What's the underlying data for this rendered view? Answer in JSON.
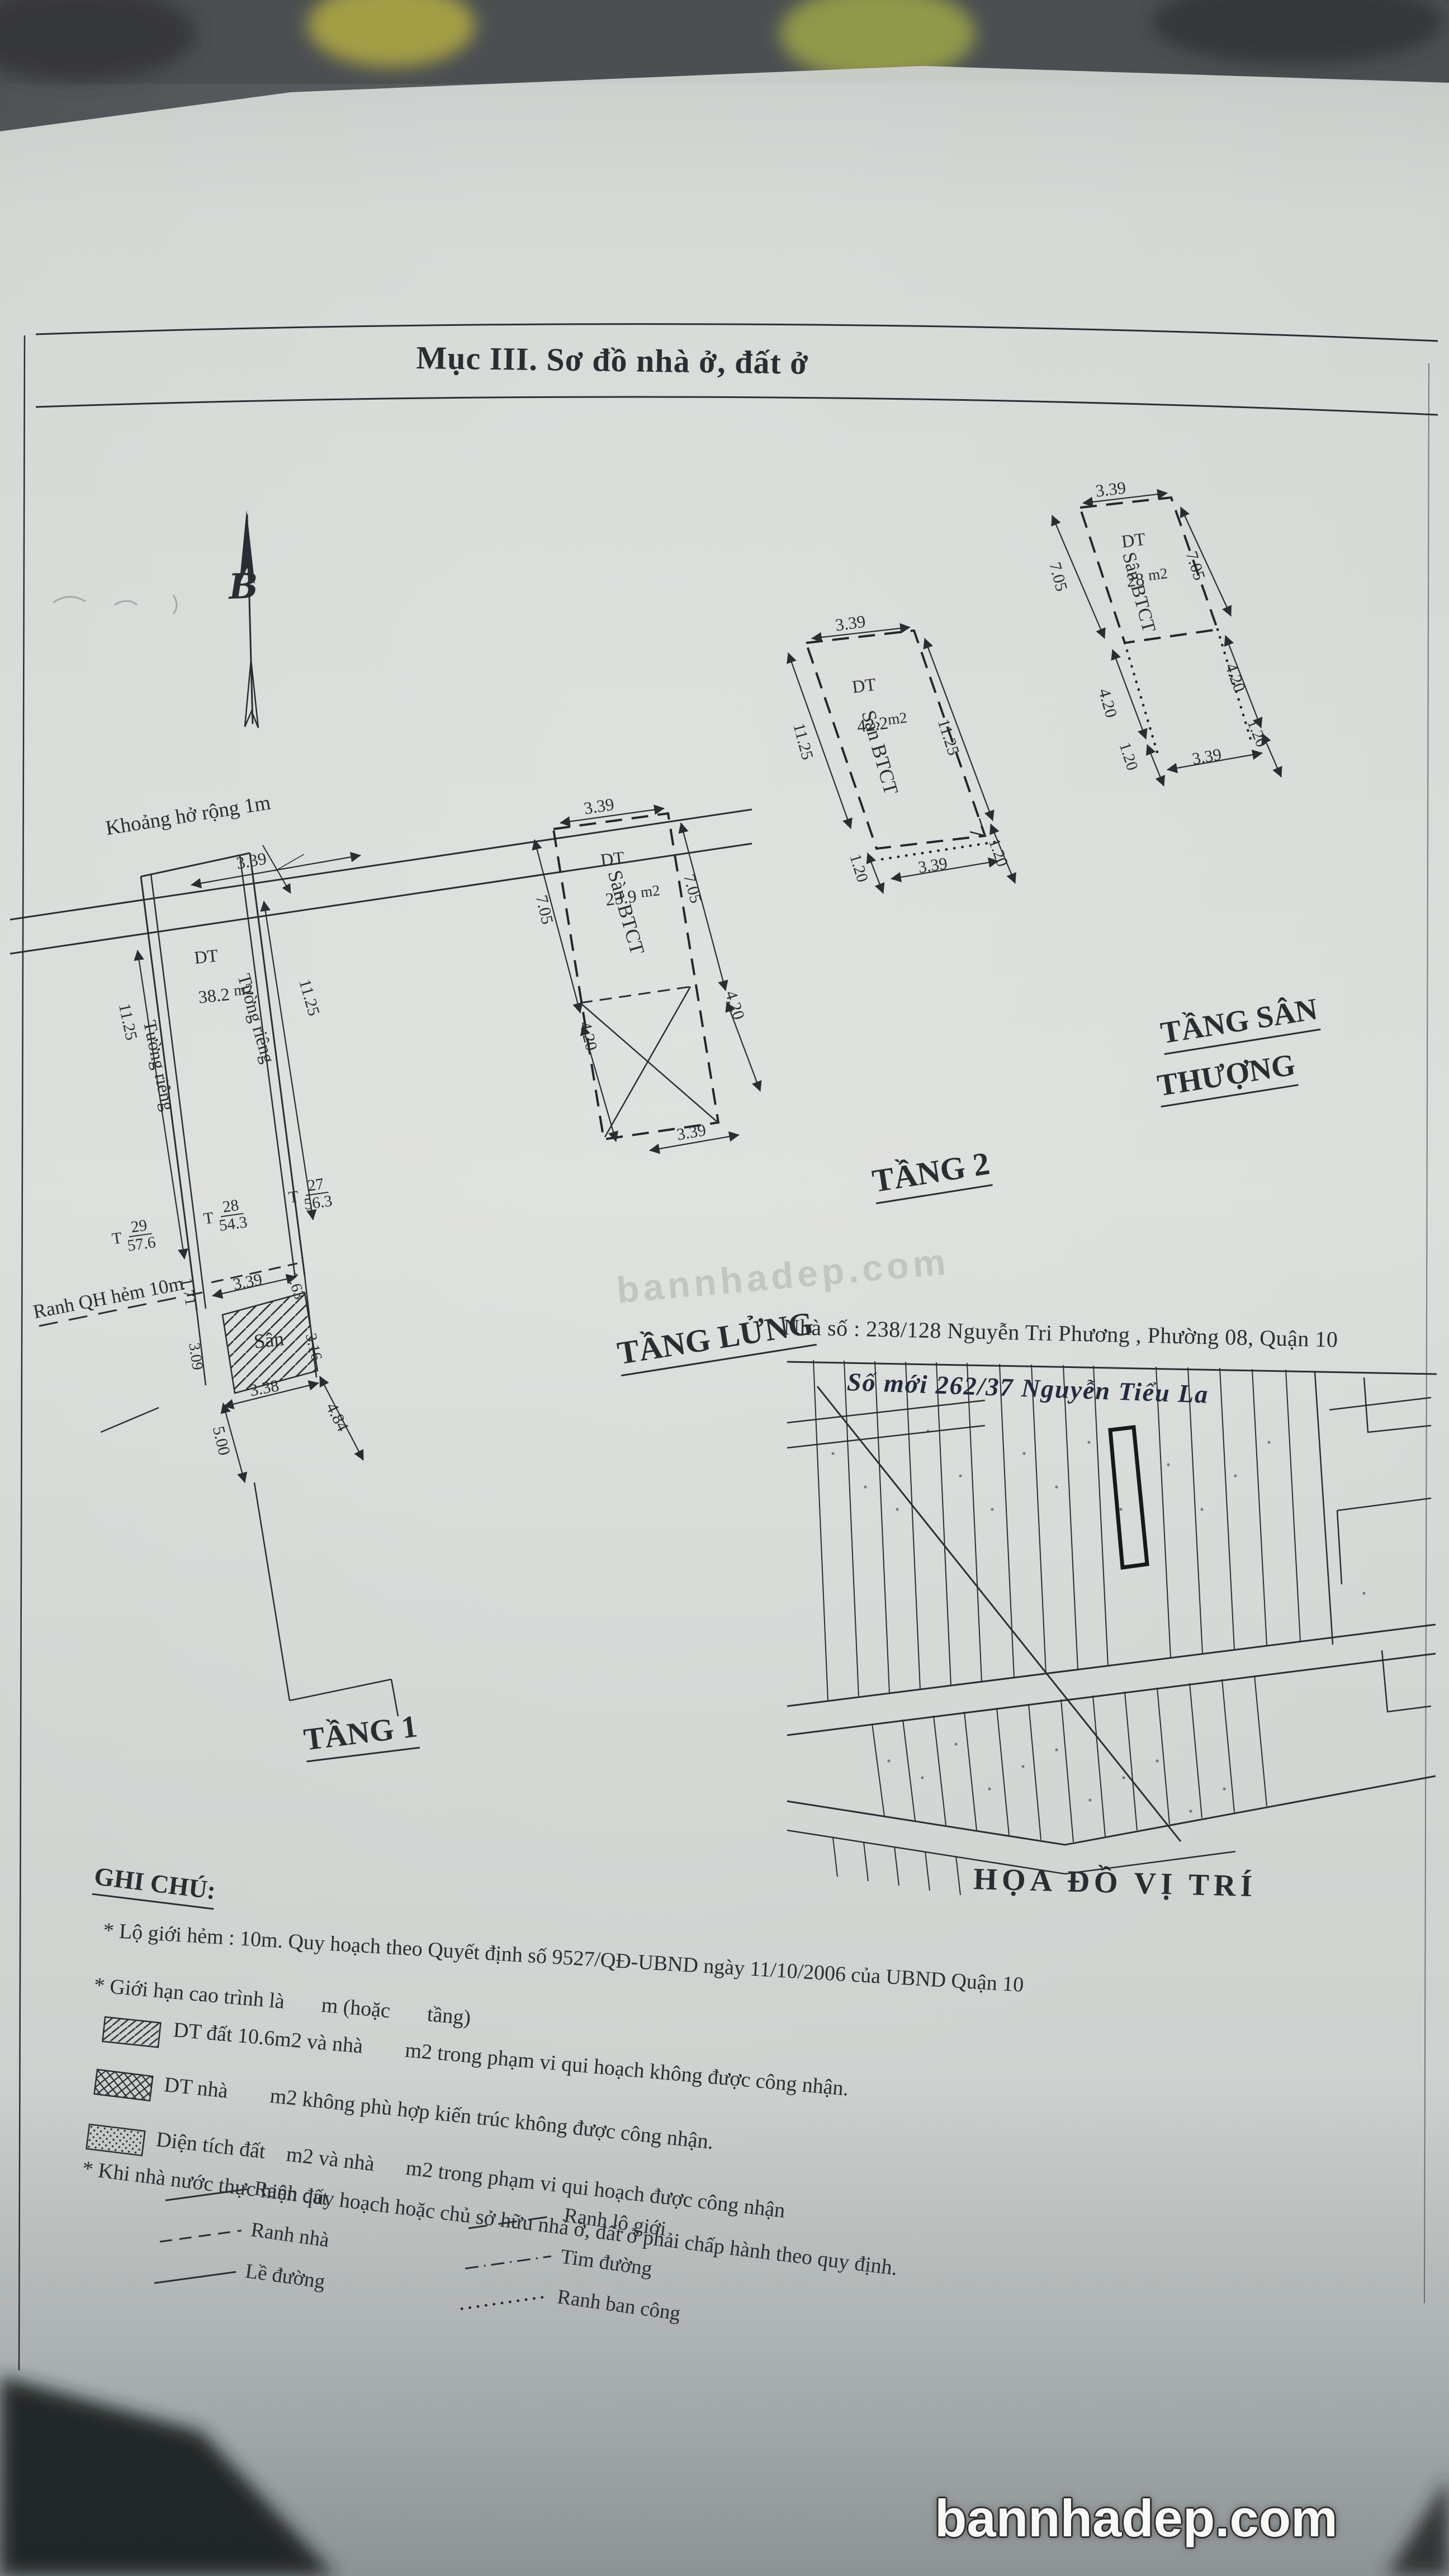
{
  "photo": {
    "ink_color": "#2b2d33",
    "paper_color": "#d6dad6"
  },
  "header": {
    "title": "Mục III. Sơ đồ nhà ở, đất ở"
  },
  "compass": {
    "letter": "B"
  },
  "plans": {
    "tang1": {
      "label": "TẦNG 1",
      "gap_note": "Khoảng hở rộng 1m",
      "alley_note": "Ranh QH hẻm 10m",
      "area_label": "DT",
      "area_value": "38.2",
      "area_unit": "m2",
      "wall_left": "Tường riêng",
      "wall_right": "Tường riêng",
      "yard_label": "Sân",
      "lot_prefix": "T",
      "lots": [
        {
          "no": "29",
          "area": "57.6"
        },
        {
          "no": "28",
          "area": "54.3"
        },
        {
          "no": "27",
          "area": "56.3"
        }
      ],
      "dims": {
        "front": "3.39",
        "left": "11.25",
        "right": "11.25",
        "inner_front": "3.39",
        "left_a": "1.71",
        "left_b": "3.09",
        "right_a": "1.63",
        "right_b": "3.16",
        "yard_width": "3.38",
        "bottom_left": "5.00",
        "bottom_right": "4.84"
      }
    },
    "tang_lung": {
      "label": "TẦNG LỬNG",
      "area_label": "DT",
      "area_value": "23.9",
      "area_unit": "m2",
      "floor_label": "Sàn BTCT",
      "dims": {
        "front": "3.39",
        "left_upper": "7.05",
        "right_upper": "7.05",
        "left_lower": "4.20",
        "right_lower": "4.20",
        "bottom": "3.39"
      }
    },
    "tang2": {
      "label": "TẦNG 2",
      "area_label": "DT",
      "area_value": "42.2",
      "area_unit": "m2",
      "floor_label": "Sân BTCT",
      "dims": {
        "front": "3.39",
        "left": "11.25",
        "right": "11.25",
        "bottom_left": "1.20",
        "bottom_right": "1.20",
        "bottom": "3.39"
      }
    },
    "tang_san_thuong": {
      "label_line1": "TẦNG SÂN",
      "label_line2": "THƯỢNG",
      "area_label": "DT",
      "area_value": "28",
      "area_unit": "m2",
      "floor_label": "Sân BTCT",
      "dims": {
        "front": "3.39",
        "left_upper": "7.05",
        "right_upper": "7.05",
        "left_mid": "4.20",
        "right_mid": "4.20",
        "left_low": "1.20",
        "right_low": "1.20",
        "bottom": "3.39"
      }
    }
  },
  "address": {
    "printed": "Nhà số : 238/128 Nguyễn Tri Phương , Phường 08, Quận 10",
    "handwritten": "Số mới 262/37 Nguyễn Tiểu La"
  },
  "map": {
    "label": "HỌA ĐỒ VỊ TRÍ"
  },
  "notes": {
    "heading": "GHI CHÚ:",
    "line1": "* Lộ giới hẻm : 10m. Quy hoạch theo Quyết định số 9527/QĐ-UBND ngày 11/10/2006 của UBND Quận 10",
    "line2": "* Giới hạn cao trình là       m (hoặc       tầng)",
    "hatch1": "DT đất 10.6m2 và nhà        m2 trong phạm vi qui hoạch không được công nhận.",
    "hatch2": "DT nhà        m2 không phù hợp kiến trúc không được công nhận.",
    "hatch3": "Diện tích đất    m2 và nhà      m2 trong phạm vi qui hoạch được công nhận",
    "line6": "* Khi nhà nước thực hiện quy hoạch hoặc chủ sở hữu nhà ở, đất ở phải chấp hành theo quy định.",
    "legend": {
      "ranh_dat": "Ranh đất",
      "ranh_nha": "Ranh nhà",
      "le_duong": "Lề đường",
      "ranh_lo_gioi": "Ranh lộ giới",
      "tim_duong": "Tim đường",
      "ranh_ban_cong": "Ranh ban công"
    }
  },
  "watermark": {
    "center": "bannhadep.com",
    "bottom": "bannhadep.com"
  }
}
